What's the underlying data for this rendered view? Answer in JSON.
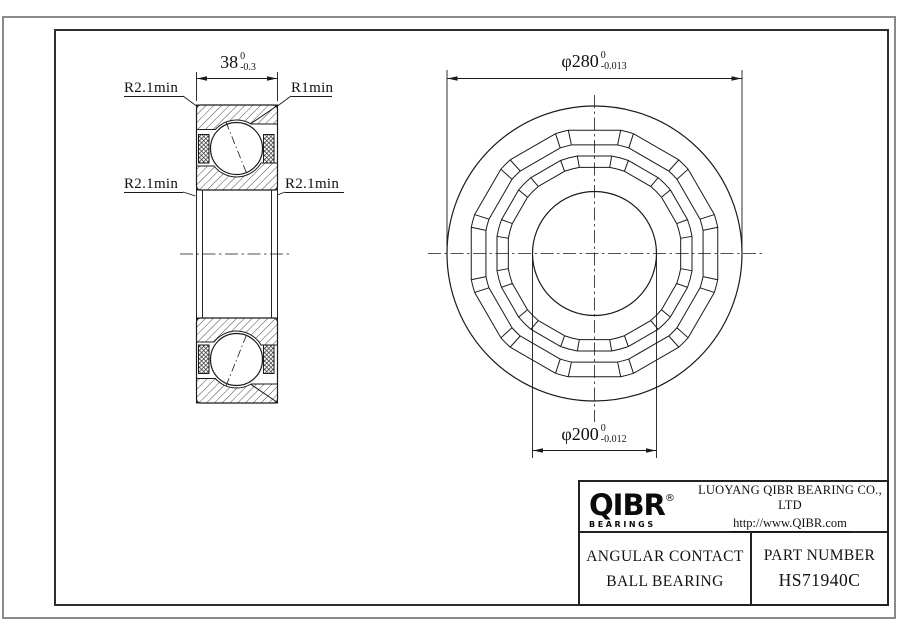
{
  "side_view": {
    "width_dim": {
      "value": "38",
      "tol_upper": "0",
      "tol_lower": "-0.3"
    },
    "label_top_left": "R2.1min",
    "label_top_right": "R1min",
    "label_mid_left": "R2.1min",
    "label_mid_right": "R2.1min"
  },
  "front_view": {
    "outer_dia_dim": {
      "value": "φ280",
      "tol_upper": "0",
      "tol_lower": "-0.013"
    },
    "bore_dia_dim": {
      "value": "φ200",
      "tol_upper": "0",
      "tol_lower": "-0.012"
    }
  },
  "title_block": {
    "logo_text": "QIBR",
    "logo_registered": "®",
    "logo_subtext": "BEARINGS",
    "company_name": "LUOYANG QIBR BEARING CO., LTD",
    "website": "http://www.QIBR.com",
    "product_type_line1": "ANGULAR CONTACT",
    "product_type_line2": "BALL BEARING",
    "part_number_label": "PART NUMBER",
    "part_number": "HS71940C"
  }
}
